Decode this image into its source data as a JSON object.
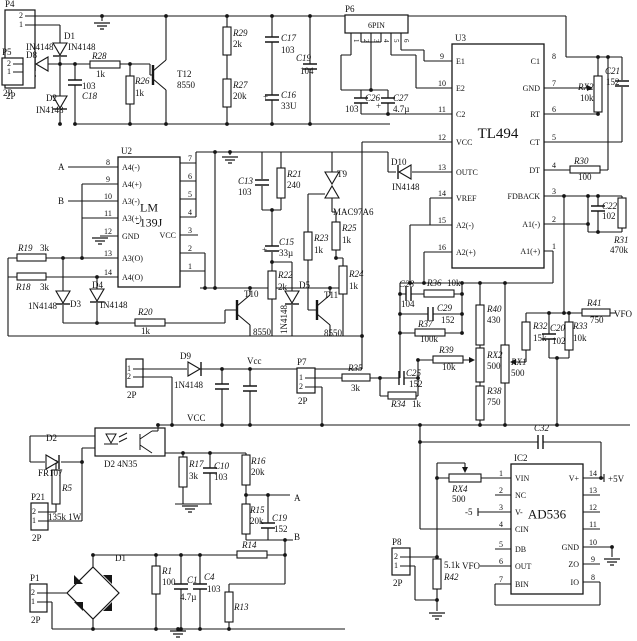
{
  "title": "TL494 / LM-139J / AD536 power control schematic",
  "colors": {
    "wire": "#161616",
    "bg": "#ffffff"
  },
  "ics": [
    {
      "ref": "U2",
      "name": [
        "LM",
        "-139J"
      ],
      "x": 118,
      "y": 157,
      "w": 62,
      "h": 130,
      "namesize": 12,
      "left": [
        [
          "8",
          "A4(-)",
          167
        ],
        [
          "9",
          "A4(+)",
          184
        ],
        [
          "10",
          "A3(-)",
          201
        ],
        [
          "11",
          "A3(+)",
          218
        ],
        [
          "12",
          "GND",
          236
        ],
        [
          "13",
          "A3(O)",
          258
        ],
        [
          "14",
          "A4(O)",
          277
        ]
      ],
      "right": [
        [
          "7",
          "",
          163
        ],
        [
          "6",
          "",
          181
        ],
        [
          "5",
          "",
          199
        ],
        [
          "4",
          "",
          217
        ],
        [
          "3",
          "VCC",
          235
        ],
        [
          "2",
          "",
          253
        ],
        [
          "1",
          "",
          271
        ]
      ]
    },
    {
      "ref": "U3",
      "name": [
        "TL494"
      ],
      "x": 452,
      "y": 44,
      "w": 92,
      "h": 224,
      "namesize": 15,
      "left": [
        [
          "9",
          "E1",
          61
        ],
        [
          "10",
          "E2",
          88
        ],
        [
          "11",
          "C2",
          114
        ],
        [
          "12",
          "VCC",
          142
        ],
        [
          "13",
          "OUTC",
          172
        ],
        [
          "14",
          "VREF",
          198
        ],
        [
          "15",
          "A2(-)",
          225
        ],
        [
          "16",
          "A2(+)",
          252
        ]
      ],
      "right": [
        [
          "8",
          "C1",
          61
        ],
        [
          "7",
          "GND",
          88
        ],
        [
          "6",
          "RT",
          114
        ],
        [
          "5",
          "CT",
          142
        ],
        [
          "4",
          "DT",
          170
        ],
        [
          "3",
          "FDBACK",
          196
        ],
        [
          "2",
          "A1(-)",
          224
        ],
        [
          "1",
          "A1(+)",
          251
        ]
      ]
    },
    {
      "ref": "IC2",
      "name": [
        "AD536"
      ],
      "x": 511,
      "y": 464,
      "w": 72,
      "h": 130,
      "namesize": 13,
      "left": [
        [
          "1",
          "VIN",
          478
        ],
        [
          "2",
          "NC",
          495
        ],
        [
          "3",
          "V-",
          512
        ],
        [
          "4",
          "CIN",
          529
        ],
        [
          "5",
          "DB",
          549
        ],
        [
          "6",
          "OUT",
          566
        ],
        [
          "7",
          "BIN",
          584
        ]
      ],
      "right": [
        [
          "14",
          "V+",
          478
        ],
        [
          "13",
          "",
          495
        ],
        [
          "12",
          "",
          512
        ],
        [
          "11",
          "",
          529
        ],
        [
          "10",
          "GND",
          547
        ],
        [
          "9",
          "ZO",
          564
        ],
        [
          "8",
          "IO",
          582
        ]
      ]
    }
  ],
  "connectors": [
    {
      "ref": "P4",
      "sub": "2P",
      "x": 5,
      "y": 10,
      "w": 30,
      "h": 78,
      "pins": [
        [
          "2",
          16
        ],
        [
          "1",
          25
        ]
      ]
    },
    {
      "ref": "P5",
      "sub": "2P",
      "x": 2,
      "y": 58,
      "w": 21,
      "h": 27,
      "pins": [
        [
          "2",
          64
        ],
        [
          "1",
          72
        ]
      ]
    },
    {
      "ref": "P6",
      "sub": "6PIN",
      "x": 345,
      "y": 15,
      "w": 63,
      "h": 18,
      "bottom": [
        [
          "1",
          351
        ],
        [
          "2",
          361
        ],
        [
          "3",
          371
        ],
        [
          "4",
          381
        ],
        [
          "5",
          391
        ],
        [
          "6",
          401
        ]
      ]
    },
    {
      "ref": "P7",
      "sub": "2P",
      "x": 297,
      "y": 368,
      "w": 18,
      "h": 25,
      "pins": [
        [
          "1",
          378
        ],
        [
          "2",
          387
        ]
      ]
    },
    {
      "ref": "",
      "sub": "2P",
      "x": 126,
      "y": 359,
      "w": 17,
      "h": 28,
      "pins": [
        [
          "1",
          369
        ],
        [
          "2",
          377
        ]
      ]
    },
    {
      "ref": "P8",
      "sub": "2P",
      "x": 392,
      "y": 548,
      "w": 18,
      "h": 27,
      "pins": [
        [
          "2",
          557
        ],
        [
          "1",
          566
        ]
      ]
    },
    {
      "ref": "P21",
      "sub": "2P",
      "x": 31,
      "y": 503,
      "w": 17,
      "h": 27,
      "pins": [
        [
          "2",
          512
        ],
        [
          "1",
          521
        ]
      ]
    },
    {
      "ref": "P1",
      "sub": "2P",
      "x": 30,
      "y": 584,
      "w": 17,
      "h": 28,
      "pins": [
        [
          "2",
          593
        ],
        [
          "1",
          602
        ]
      ]
    }
  ],
  "labels": [
    [
      "D1",
      64,
      39
    ],
    [
      "IN4148",
      26,
      50
    ],
    [
      "IN4148",
      68,
      50
    ],
    [
      "D8",
      26,
      58
    ],
    [
      "D2",
      46,
      101
    ],
    [
      "IN4148",
      36,
      113
    ],
    [
      "R28",
      92,
      59,
      "i"
    ],
    [
      "1k",
      96,
      77
    ],
    [
      "R26",
      135,
      84,
      "i"
    ],
    [
      "1k",
      135,
      96
    ],
    [
      "103",
      82,
      89
    ],
    [
      "C18",
      82,
      99,
      "i"
    ],
    [
      "T12",
      177,
      77
    ],
    [
      "8550",
      177,
      88
    ],
    [
      "R29",
      233,
      36,
      "i"
    ],
    [
      "2k",
      233,
      47
    ],
    [
      "R27",
      233,
      88,
      "i"
    ],
    [
      "20k",
      233,
      99
    ],
    [
      "C17",
      281,
      41,
      "i"
    ],
    [
      "103",
      281,
      53
    ],
    [
      "C16",
      281,
      98,
      "i"
    ],
    [
      "33U",
      281,
      109
    ],
    [
      "+",
      263,
      100
    ],
    [
      "C19",
      296,
      61,
      "i"
    ],
    [
      "104",
      300,
      74
    ],
    [
      "C26",
      365,
      101,
      "i"
    ],
    [
      "103",
      345,
      112
    ],
    [
      "C27",
      393,
      101,
      "i"
    ],
    [
      "4.7µ",
      393,
      112
    ],
    [
      "+",
      376,
      109
    ],
    [
      "RX2",
      578,
      90,
      "i"
    ],
    [
      "10k",
      580,
      101
    ],
    [
      "C21",
      605,
      74,
      "i"
    ],
    [
      "152",
      606,
      85
    ],
    [
      "R30",
      574,
      164,
      "i"
    ],
    [
      "100",
      578,
      180
    ],
    [
      "C22",
      602,
      209,
      "i"
    ],
    [
      "102",
      602,
      219
    ],
    [
      "R31",
      614,
      243,
      "i"
    ],
    [
      "470k",
      610,
      253
    ],
    [
      "A",
      58,
      170
    ],
    [
      "B",
      58,
      204
    ],
    [
      "R19",
      18,
      251,
      "i"
    ],
    [
      "3k",
      40,
      251
    ],
    [
      "R18",
      16,
      290,
      "i"
    ],
    [
      "3k",
      40,
      290
    ],
    [
      "1N4148",
      28,
      309
    ],
    [
      "D3",
      70,
      307
    ],
    [
      "D4",
      92,
      288
    ],
    [
      "IN4148",
      100,
      308
    ],
    [
      "R20",
      138,
      315,
      "i"
    ],
    [
      "1k",
      141,
      334
    ],
    [
      "C13",
      238,
      184,
      "i"
    ],
    [
      "103",
      238,
      195
    ],
    [
      "R21",
      287,
      177,
      "i"
    ],
    [
      "240",
      287,
      188
    ],
    [
      "T9",
      337,
      177
    ],
    [
      "MAC97A6",
      333,
      215
    ],
    [
      "D10",
      391,
      165
    ],
    [
      "IN4148",
      392,
      190
    ],
    [
      "C15",
      279,
      245,
      "i"
    ],
    [
      "33µ",
      279,
      256
    ],
    [
      "+",
      262,
      253
    ],
    [
      "R23",
      314,
      241,
      "i"
    ],
    [
      "1k",
      314,
      253
    ],
    [
      "R25",
      342,
      231,
      "i"
    ],
    [
      "1k",
      342,
      243
    ],
    [
      "R24",
      349,
      277,
      "i"
    ],
    [
      "1k",
      349,
      289
    ],
    [
      "R22",
      278,
      278,
      "i"
    ],
    [
      "2k",
      278,
      290
    ],
    [
      "D5",
      299,
      288
    ],
    [
      "1N4148",
      287,
      334,
      "v"
    ],
    [
      "T10",
      244,
      297
    ],
    [
      "8550",
      253,
      335
    ],
    [
      "T11",
      324,
      298
    ],
    [
      "8550",
      324,
      336
    ],
    [
      "D9",
      180,
      359
    ],
    [
      "1N4148",
      174,
      388
    ],
    [
      "Vcc",
      247,
      364
    ],
    [
      "R35",
      348,
      371,
      "i"
    ],
    [
      "3k",
      351,
      391
    ],
    [
      "C25",
      406,
      376,
      "i"
    ],
    [
      "152",
      409,
      387
    ],
    [
      "R34",
      391,
      407,
      "i"
    ],
    [
      "1k",
      412,
      407
    ],
    [
      "C28",
      399,
      287,
      "i"
    ],
    [
      "104",
      401,
      307
    ],
    [
      "R36",
      427,
      286,
      "i"
    ],
    [
      "10k",
      447,
      286
    ],
    [
      "C29",
      437,
      311,
      "i"
    ],
    [
      "152",
      441,
      323
    ],
    [
      "R37",
      418,
      327,
      "i"
    ],
    [
      "100k",
      420,
      342
    ],
    [
      "R39",
      439,
      353,
      "i"
    ],
    [
      "10k",
      442,
      370
    ],
    [
      "R40",
      487,
      312,
      "i"
    ],
    [
      "430",
      487,
      323
    ],
    [
      "RX2",
      487,
      358,
      "i"
    ],
    [
      "500",
      487,
      369
    ],
    [
      "R38",
      487,
      394,
      "i"
    ],
    [
      "750",
      487,
      405
    ],
    [
      "RX1",
      511,
      365,
      "i"
    ],
    [
      "500",
      511,
      376
    ],
    [
      "R32",
      533,
      329,
      "i"
    ],
    [
      "15k",
      533,
      341
    ],
    [
      "C20",
      550,
      331,
      "i"
    ],
    [
      "102",
      552,
      344
    ],
    [
      "R33",
      573,
      329,
      "i"
    ],
    [
      "10k",
      573,
      341
    ],
    [
      "R41",
      587,
      306,
      "i"
    ],
    [
      "750",
      590,
      323
    ],
    [
      "VFO",
      614,
      317
    ],
    [
      "D2",
      46,
      441
    ],
    [
      "FR107",
      38,
      476
    ],
    [
      "R5",
      62,
      491,
      "i"
    ],
    [
      "135k 1W",
      48,
      520
    ],
    [
      "D2 4N35",
      104,
      467
    ],
    [
      "VCC",
      187,
      421
    ],
    [
      "R17",
      189,
      467,
      "i"
    ],
    [
      "3k",
      189,
      479
    ],
    [
      "C10",
      214,
      469,
      "i"
    ],
    [
      "103",
      214,
      480
    ],
    [
      "R16",
      251,
      464,
      "i"
    ],
    [
      "20k",
      251,
      475
    ],
    [
      "R15",
      250,
      513,
      "i"
    ],
    [
      "20k",
      250,
      524
    ],
    [
      "C19",
      272,
      521,
      "i"
    ],
    [
      "152",
      274,
      532
    ],
    [
      "A",
      294,
      501
    ],
    [
      "B",
      294,
      540
    ],
    [
      "R14",
      242,
      548,
      "i"
    ],
    [
      "R13",
      234,
      610,
      "i"
    ],
    [
      "R1",
      162,
      574,
      "i"
    ],
    [
      "100",
      162,
      585
    ],
    [
      "C1",
      187,
      583,
      "i"
    ],
    [
      "4.7µ",
      180,
      600
    ],
    [
      "C4",
      204,
      580,
      "i"
    ],
    [
      "103",
      207,
      592
    ],
    [
      "D1",
      115,
      561
    ],
    [
      "C32",
      534,
      431,
      "i"
    ],
    [
      "RX4",
      452,
      492,
      "i"
    ],
    [
      "500",
      452,
      502
    ],
    [
      "+5V",
      608,
      482
    ],
    [
      "-5",
      465,
      515
    ],
    [
      "VFO",
      462,
      569
    ],
    [
      "5.1k",
      444,
      568
    ],
    [
      "R42",
      444,
      580,
      "i"
    ]
  ]
}
